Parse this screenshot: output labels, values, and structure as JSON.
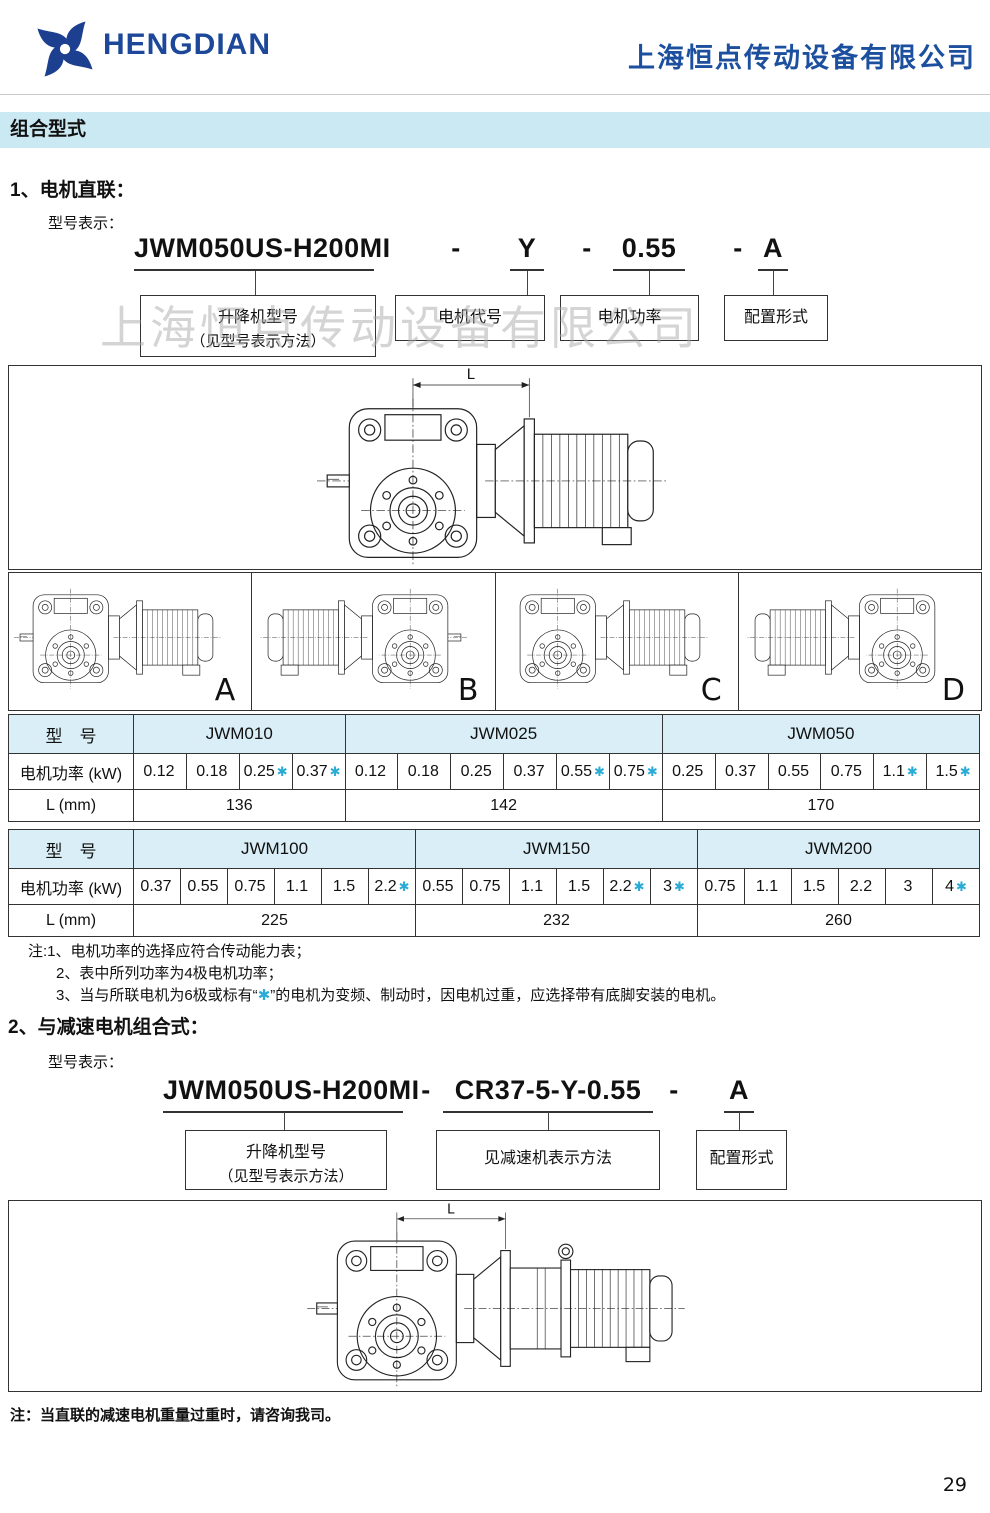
{
  "header": {
    "logo_text": "HENGDIAN",
    "company_name": "上海恒点传动设备有限公司"
  },
  "banner": {
    "title": "组合型式"
  },
  "watermark": "上海恒点传动设备有限公司",
  "colors": {
    "brand_blue": "#1d4f9f",
    "banner_bg": "#cbe9f3",
    "table_header_bg": "#d9eef6",
    "star_cyan": "#29abd6"
  },
  "section1": {
    "heading": "1、电机直联：",
    "subheading": "型号表示：",
    "code": {
      "p1": "JWM050US-H200MI",
      "dash": "-",
      "p2": "Y",
      "p3": "0.55",
      "p4": "A"
    },
    "labels": {
      "box1_line1": "升降机型号",
      "box1_line2": "（见型号表示方法）",
      "box2": "电机代号",
      "box3": "电机功率",
      "box4": "配置形式"
    },
    "dim_label": "L",
    "configs": [
      "A",
      "B",
      "C",
      "D"
    ]
  },
  "tables": {
    "row_headers": {
      "model": "型　号",
      "power": "电机功率 (kW)",
      "length": "L (mm)"
    },
    "t1": {
      "groups": [
        {
          "model": "JWM010",
          "L": "136",
          "powers": [
            {
              "v": "0.12",
              "s": ""
            },
            {
              "v": "0.18",
              "s": ""
            },
            {
              "v": "0.25",
              "s": "✱"
            },
            {
              "v": "0.37",
              "s": "✱"
            }
          ]
        },
        {
          "model": "JWM025",
          "L": "142",
          "powers": [
            {
              "v": "0.12",
              "s": ""
            },
            {
              "v": "0.18",
              "s": ""
            },
            {
              "v": "0.25",
              "s": ""
            },
            {
              "v": "0.37",
              "s": ""
            },
            {
              "v": "0.55",
              "s": "✱"
            },
            {
              "v": "0.75",
              "s": "✱"
            }
          ]
        },
        {
          "model": "JWM050",
          "L": "170",
          "powers": [
            {
              "v": "0.25",
              "s": ""
            },
            {
              "v": "0.37",
              "s": ""
            },
            {
              "v": "0.55",
              "s": ""
            },
            {
              "v": "0.75",
              "s": ""
            },
            {
              "v": "1.1",
              "s": "✱"
            },
            {
              "v": "1.5",
              "s": "✱"
            }
          ]
        }
      ]
    },
    "t2": {
      "groups": [
        {
          "model": "JWM100",
          "L": "225",
          "powers": [
            {
              "v": "0.37",
              "s": ""
            },
            {
              "v": "0.55",
              "s": ""
            },
            {
              "v": "0.75",
              "s": ""
            },
            {
              "v": "1.1",
              "s": ""
            },
            {
              "v": "1.5",
              "s": ""
            },
            {
              "v": "2.2",
              "s": "✱"
            }
          ]
        },
        {
          "model": "JWM150",
          "L": "232",
          "powers": [
            {
              "v": "0.55",
              "s": ""
            },
            {
              "v": "0.75",
              "s": ""
            },
            {
              "v": "1.1",
              "s": ""
            },
            {
              "v": "1.5",
              "s": ""
            },
            {
              "v": "2.2",
              "s": "✱"
            },
            {
              "v": "3",
              "s": "✱"
            }
          ]
        },
        {
          "model": "JWM200",
          "L": "260",
          "powers": [
            {
              "v": "0.75",
              "s": ""
            },
            {
              "v": "1.1",
              "s": ""
            },
            {
              "v": "1.5",
              "s": ""
            },
            {
              "v": "2.2",
              "s": ""
            },
            {
              "v": "3",
              "s": ""
            },
            {
              "v": "4",
              "s": "✱"
            }
          ]
        }
      ]
    }
  },
  "notes": {
    "line1": "注:1、电机功率的选择应符合传动能力表；",
    "line2": "2、表中所列功率为4极电机功率；",
    "line3_pre": "3、当与所联电机为6极或标有“",
    "line3_star": "✱",
    "line3_post": "”的电机为变频、制动时，因电机过重，应选择带有底脚安装的电机。"
  },
  "section2": {
    "heading": "2、与减速电机组合式：",
    "subheading": "型号表示：",
    "code": {
      "p1": "JWM050US-H200MI",
      "dash": "-",
      "p2": "CR37-5-Y-0.55",
      "p3": "A"
    },
    "labels": {
      "box1_line1": "升降机型号",
      "box1_line2": "（见型号表示方法）",
      "box2": "见减速机表示方法",
      "box3": "配置形式"
    },
    "dim_label": "L",
    "note": "注：当直联的减速电机重量过重时，请咨询我司。"
  },
  "footer": {
    "page_number": "29"
  }
}
